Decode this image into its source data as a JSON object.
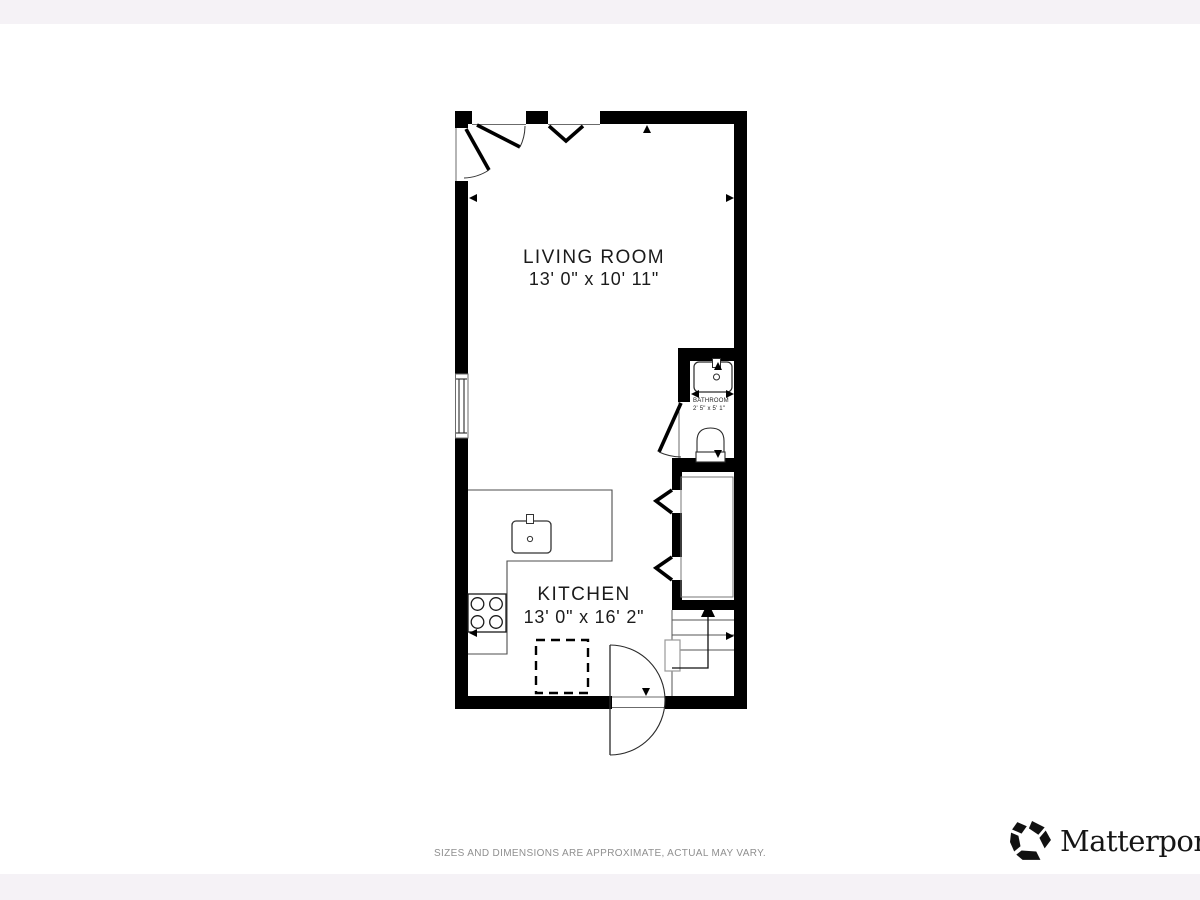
{
  "page": {
    "background": "#ffffff",
    "margin_band_color": "#f5f2f6"
  },
  "floor_plan": {
    "wall_color": "#000000",
    "rooms": [
      {
        "id": "living-room",
        "name": "LIVING ROOM",
        "dimensions": "13' 0\" x 10' 11\""
      },
      {
        "id": "kitchen",
        "name": "KITCHEN",
        "dimensions": "13' 0\" x 16' 2\""
      },
      {
        "id": "bathroom",
        "name": "BATHROOM",
        "dimensions": "2' 5\" x 5' 1\""
      }
    ],
    "fixtures": [
      "kitchen-counter",
      "kitchen-sink",
      "stove-burners",
      "dishwasher-dashed",
      "bathroom-vanity",
      "toilet",
      "window",
      "closet-bifold-doors",
      "entry-double-swing-door",
      "stairs"
    ],
    "stairs_direction": "up"
  },
  "footer": {
    "disclaimer": "SIZES AND DIMENSIONS ARE APPROXIMATE, ACTUAL MAY VARY."
  },
  "branding": {
    "logo_text": "Matterport",
    "registered_mark": "®",
    "logo_color": "#111111"
  }
}
